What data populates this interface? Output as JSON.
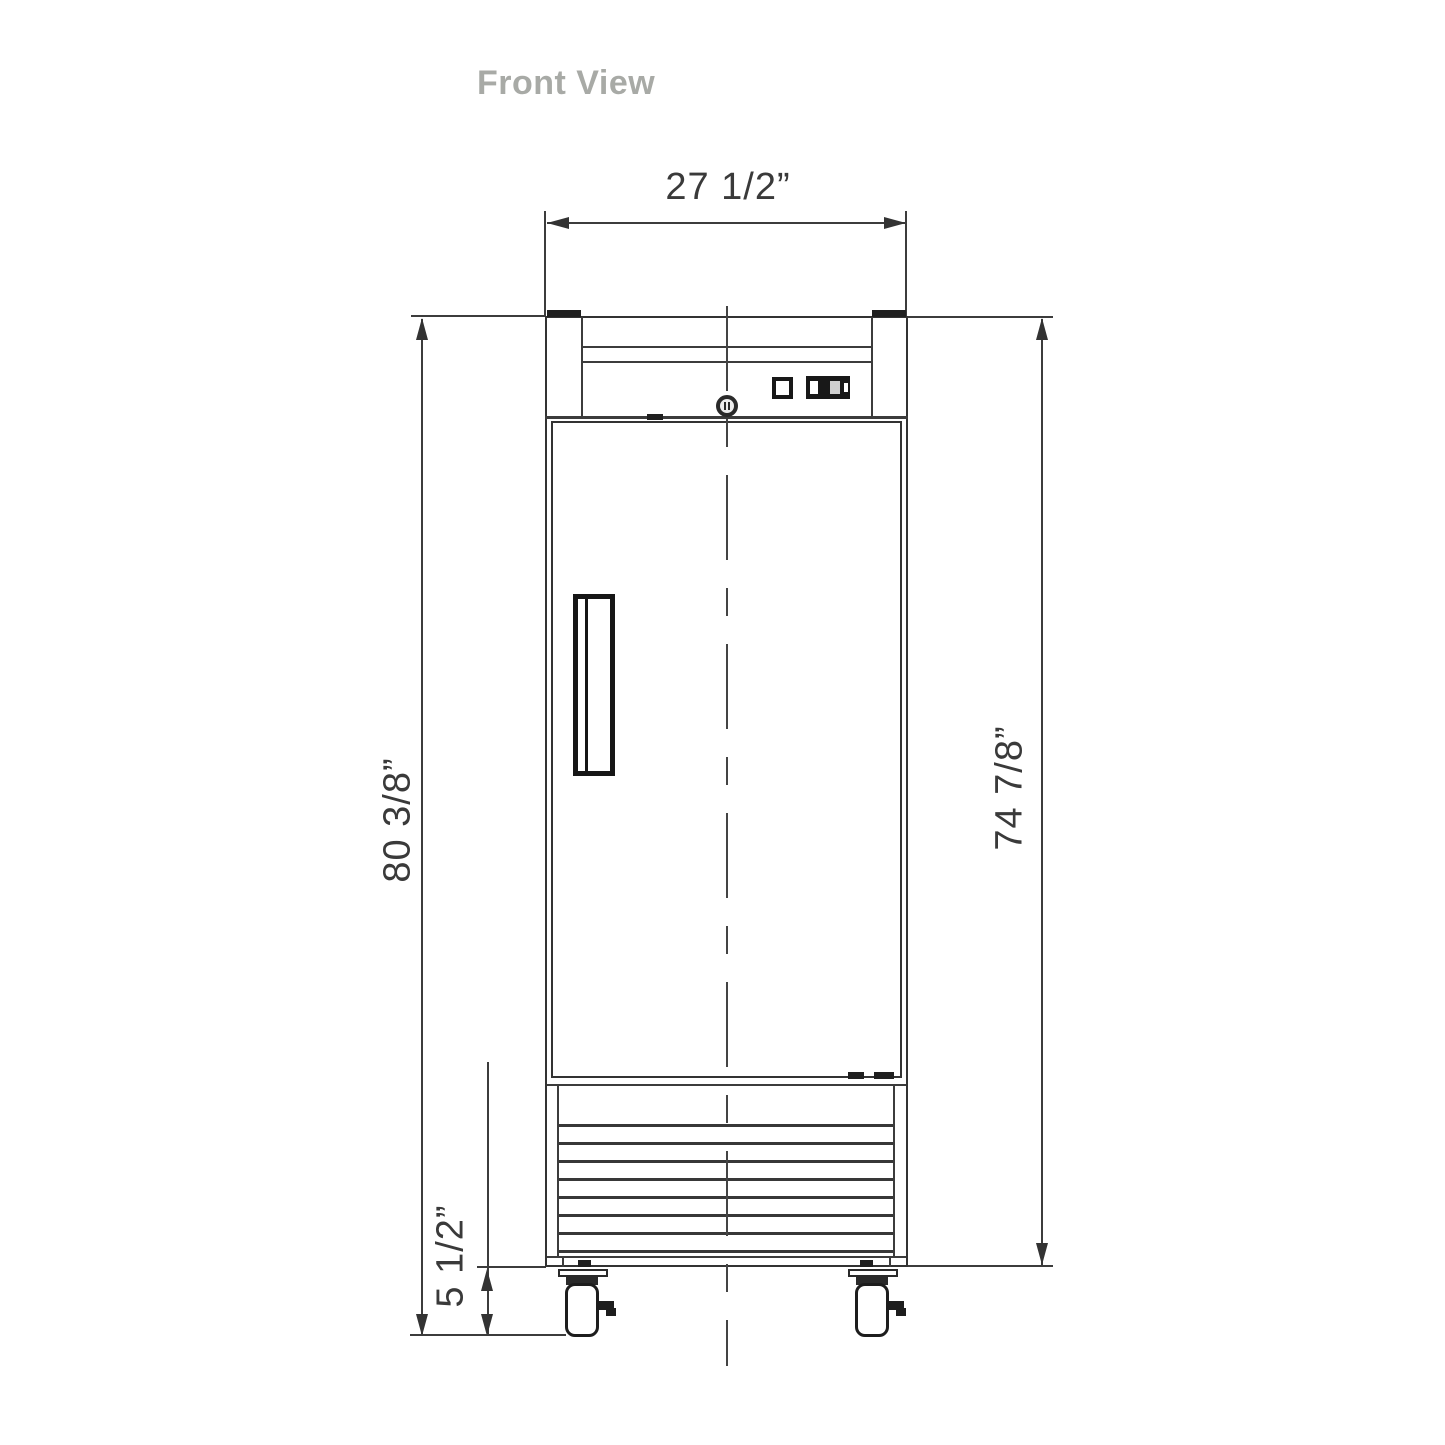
{
  "title": "Front View",
  "drawing": {
    "type": "technical-front-view",
    "subject": "single-door reach-in refrigerator",
    "dimensions": {
      "width_label": "27 1/2”",
      "overall_height_label": "80 3/8”",
      "body_height_label": "74 7/8”",
      "caster_height_label": "5 1/2”"
    },
    "colors": {
      "line": "#3c3c3c",
      "detail": "#1f1f1f",
      "title_text": "#a8aaa6",
      "dimension_text": "#3a3a3a",
      "background": "#ffffff"
    }
  }
}
